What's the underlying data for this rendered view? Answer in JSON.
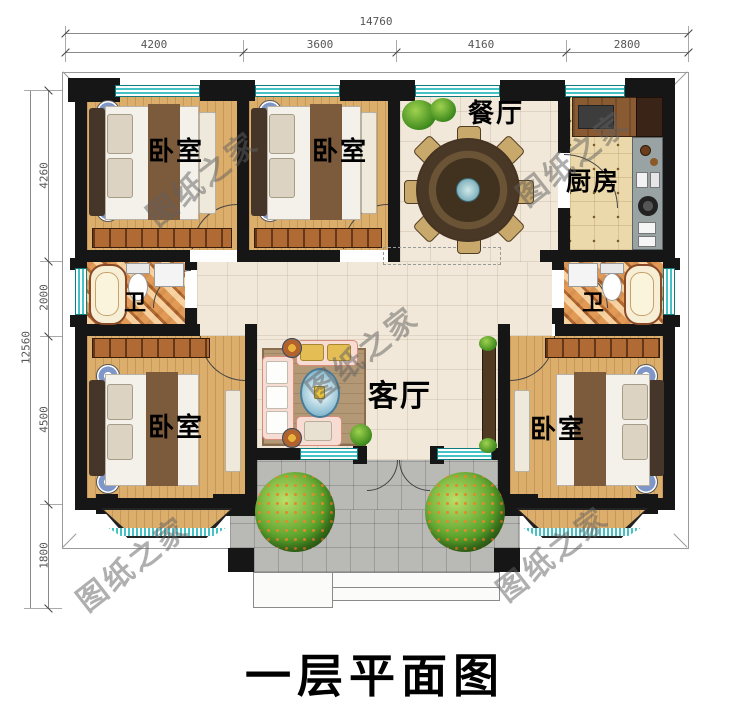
{
  "title": "一层平面图",
  "watermark": "图纸之家",
  "dimensions": {
    "top": {
      "total": "14760",
      "segments": [
        "4200",
        "3600",
        "4160",
        "2800"
      ]
    },
    "left": {
      "total": "12560",
      "segments": [
        "4260",
        "2000",
        "4500",
        "1800"
      ]
    }
  },
  "rooms": {
    "bedroom_top_left": "卧室",
    "bedroom_top_middle": "卧室",
    "dining": "餐厅",
    "kitchen": "厨房",
    "bath_left": "卫",
    "bath_right": "卫",
    "living": "客厅",
    "bedroom_bottom_left": "卧室",
    "bedroom_bottom_right": "卧室"
  },
  "colors": {
    "wall": "#161616",
    "window_glass": "#45c2c5",
    "wood_floor": "#dcae6c",
    "tile_floor": "#f1e8d9",
    "kitchen_floor": "#ecd9ab",
    "porch_floor": "#b9b9b6",
    "watermark_gray": "#5f5f5f"
  }
}
